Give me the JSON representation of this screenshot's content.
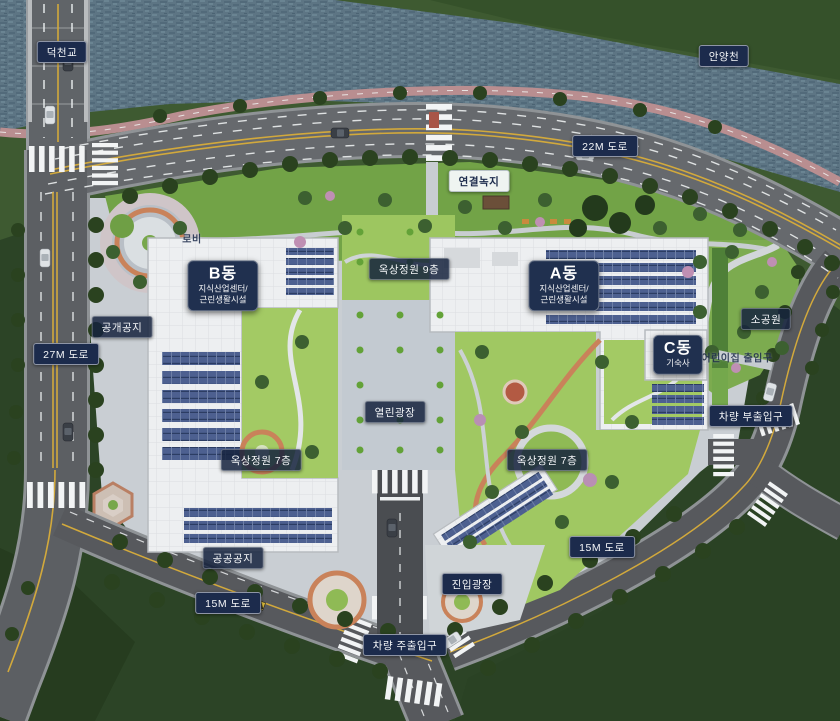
{
  "plan": {
    "type": "site-plan-rendering",
    "labels": {
      "bridge": "덕천교",
      "river": "안양천",
      "road_22m": "22M 도로",
      "road_27m": "27M 도로",
      "road_15m_left": "15M 도로",
      "road_15m_right": "15M 도로",
      "green_link": "연결녹지",
      "lobby": "로비",
      "open_space": "공개공지",
      "small_park": "소공원",
      "daycare_entrance": "어린이집 출입구",
      "vehicle_sub_entrance": "차량 부출입구",
      "open_plaza": "열린광장",
      "roof_garden_9f": "옥상정원 9층",
      "roof_garden_7f_left": "옥상정원 7층",
      "roof_garden_7f_right": "옥상정원 7층",
      "public_open_space": "공공공지",
      "entry_plaza": "진입광장",
      "vehicle_main_entrance": "차량 주출입구"
    },
    "buildings": [
      {
        "id": "B",
        "name": "B동",
        "desc_line1": "지식산업센터/",
        "desc_line2": "근린생활시설"
      },
      {
        "id": "A",
        "name": "A동",
        "desc_line1": "지식산업센터/",
        "desc_line2": "근린생활시설"
      },
      {
        "id": "C",
        "name": "C동",
        "desc_line1": "기숙사"
      }
    ],
    "colors": {
      "label_navy": "#1c2b4c",
      "water": "#5d7584",
      "river_bank": "#3e5a31",
      "field_green": "#2c4426",
      "lawn": "#a3ca64",
      "roof_white": "#edeff1",
      "solar_panel": "#4d6090",
      "asphalt": "#66696d",
      "paving": "#c9ced3",
      "terracotta": "#c9825a",
      "bike_path": "#b98e90"
    }
  }
}
